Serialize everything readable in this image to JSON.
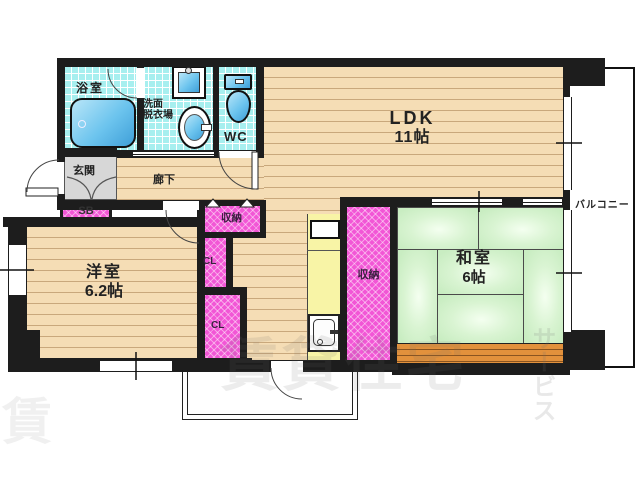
{
  "rooms": {
    "bathroom": {
      "label": "浴室"
    },
    "washroom": {
      "label1": "洗面",
      "label2": "脱衣場"
    },
    "toilet": {
      "label": "WC"
    },
    "ldk": {
      "label": "LDK",
      "size": "11帖"
    },
    "entrance": {
      "label": "玄関"
    },
    "hallway": {
      "label": "廊下"
    },
    "shoebox": {
      "label": "SB"
    },
    "hall_storage": {
      "label": "収納"
    },
    "closet_upper": {
      "label": "CL"
    },
    "closet_lower": {
      "label": "CL"
    },
    "center_storage": {
      "label": "収納"
    },
    "japanese_room": {
      "label": "和室",
      "size": "6帖"
    },
    "western_room": {
      "label": "洋室",
      "size": "6.2帖"
    },
    "balcony": {
      "label": "バルコニー"
    }
  },
  "watermark": {
    "main": "賃貸住宅",
    "vertical": "サービス",
    "corner": "賃"
  },
  "colors": {
    "wall": "#1d1d1d",
    "tile": "#a7efef",
    "wood": "#f5ddb5",
    "wood_line": "#c9a87c",
    "tatami": "#cdeec6",
    "storage_pink": "#f256d6",
    "kitchen_yellow": "#f8f4a6",
    "entrance_gray": "#d7d7d7",
    "deck_orange": "#e2913c",
    "fixture_blue": "#6cc4ee"
  }
}
